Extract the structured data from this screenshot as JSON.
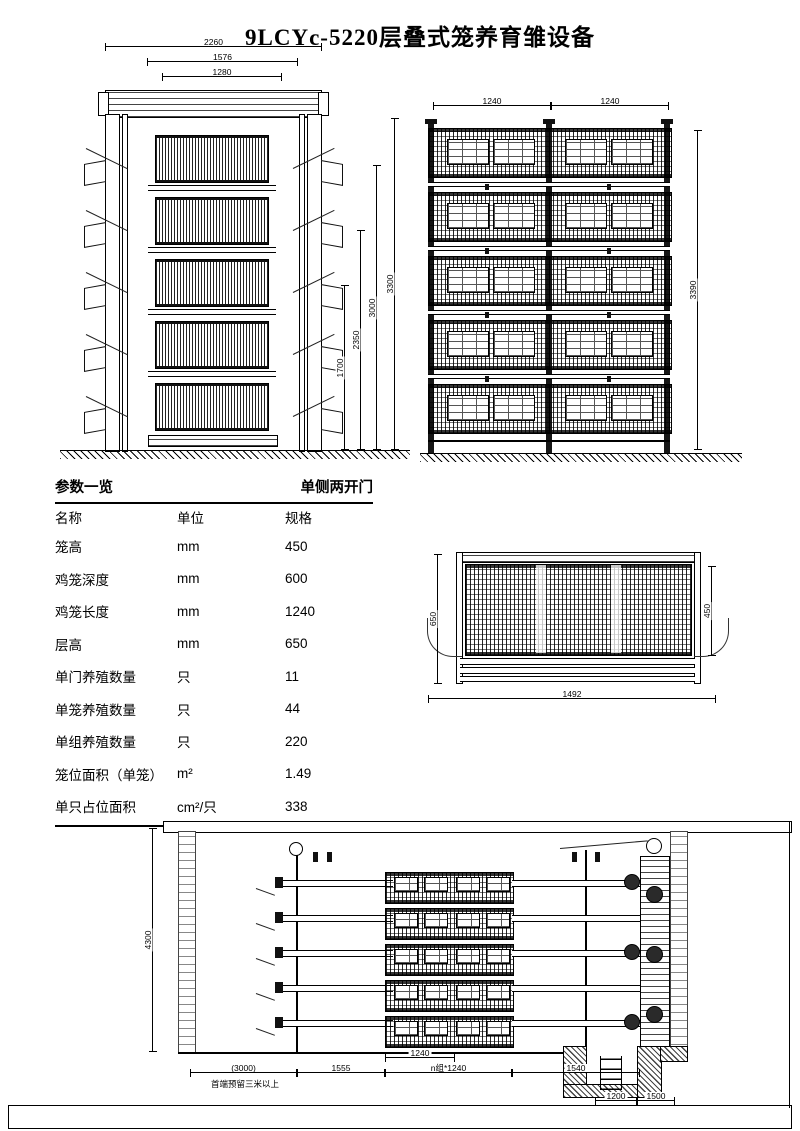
{
  "title": "9LCYc-5220层叠式笼养育雏设备",
  "side_view": {
    "dim_2260": "2260",
    "dim_1576": "1576",
    "dim_1280": "1280",
    "dim_1700": "1700",
    "dim_2350": "2350",
    "dim_3000": "3000",
    "dim_3300": "3300"
  },
  "front_view": {
    "dim_left_bay": "1240",
    "dim_right_bay": "1240",
    "dim_height": "3390"
  },
  "table": {
    "header_left": "参数一览",
    "header_right": "单侧两开门",
    "columns": [
      "名称",
      "单位",
      "规格"
    ],
    "rows": [
      [
        "笼高",
        "mm",
        "450"
      ],
      [
        "鸡笼深度",
        "mm",
        "600"
      ],
      [
        "鸡笼长度",
        "mm",
        "1240"
      ],
      [
        "层高",
        "mm",
        "650"
      ],
      [
        "单门养殖数量",
        "只",
        "11"
      ],
      [
        "单笼养殖数量",
        "只",
        "44"
      ],
      [
        "单组养殖数量",
        "只",
        "220"
      ],
      [
        "笼位面积（单笼）",
        "m²",
        "1.49"
      ],
      [
        "单只占位面积",
        "cm²/只",
        "338"
      ]
    ]
  },
  "section_view": {
    "dim_height_left": "650",
    "dim_height_right": "450",
    "dim_width": "1492"
  },
  "elevation": {
    "dim_height": "4300",
    "dim_reserve": "(3000)",
    "note_reserve": "首端预留三米以上",
    "dim_1555": "1555",
    "dim_cage": "1240",
    "dim_ncage": "n组*1240",
    "dim_1540": "1540",
    "dim_pit_1200": "1200",
    "dim_pit_1500": "1500"
  }
}
